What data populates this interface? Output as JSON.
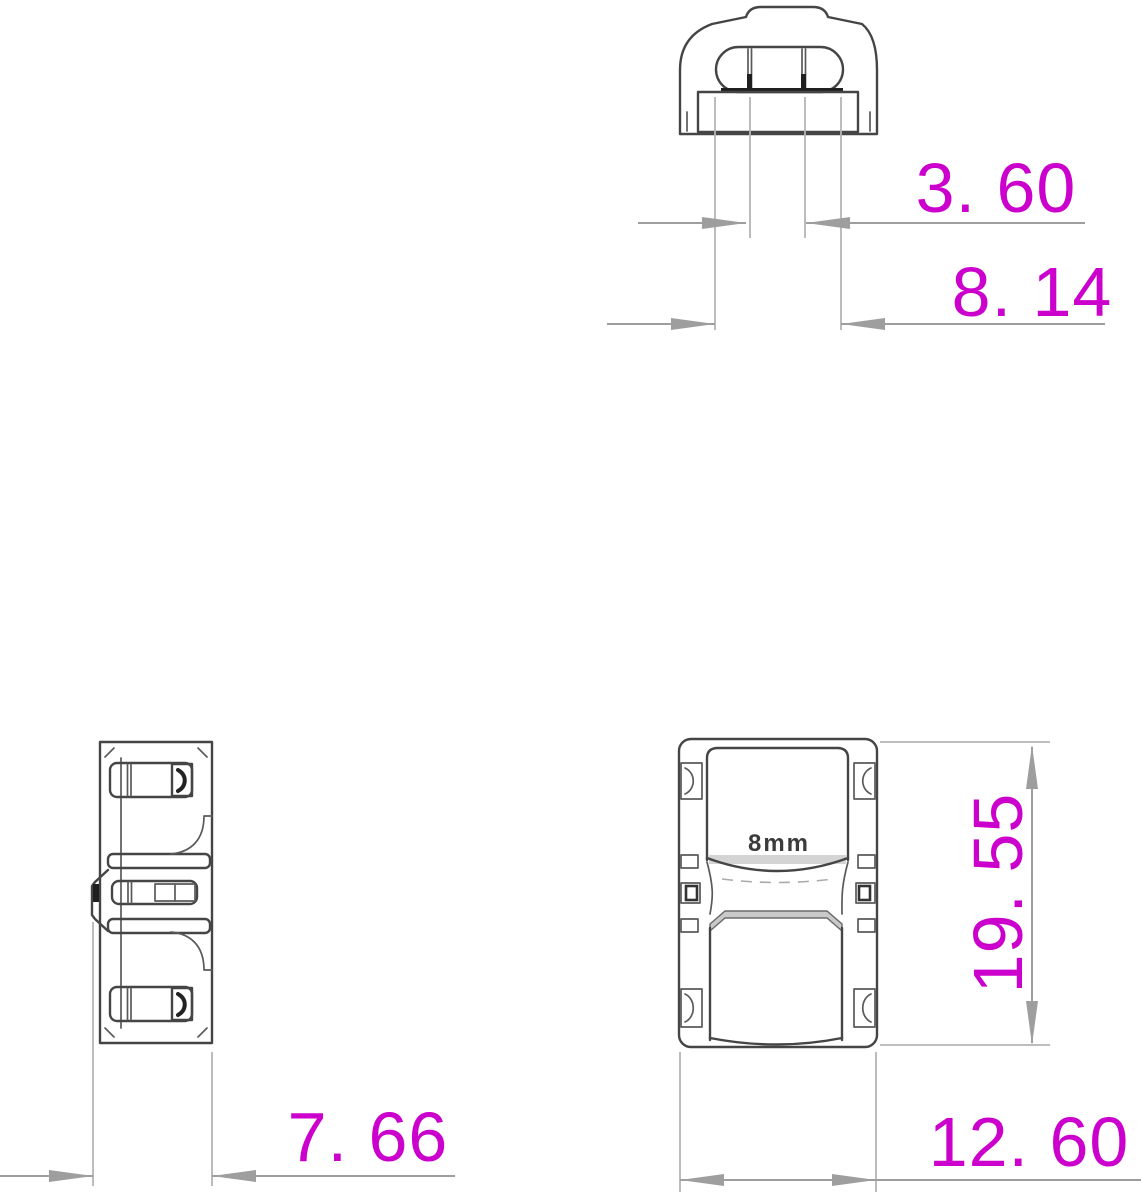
{
  "drawing": {
    "background": "#ffffff",
    "colors": {
      "dimension_text": "#cc00cc",
      "dimension_line": "#9e9e9e",
      "extension_line": "#b5b5b5",
      "part_outline": "#454545",
      "dark_detail": "#1f1f1f",
      "shading": "#c9c9c9"
    },
    "marking": {
      "front_label": "8mm"
    },
    "dimensions": {
      "slot_pitch": {
        "label": "3. 60",
        "value_mm": 3.6,
        "orientation": "horizontal",
        "view": "top"
      },
      "opening_width": {
        "label": "8. 14",
        "value_mm": 8.14,
        "orientation": "horizontal",
        "view": "top"
      },
      "body_height": {
        "label": "19. 55",
        "value_mm": 19.55,
        "orientation": "vertical",
        "view": "front"
      },
      "body_depth": {
        "label": "7. 66",
        "value_mm": 7.66,
        "orientation": "horizontal",
        "view": "side"
      },
      "body_width": {
        "label": "12. 60",
        "value_mm": 12.6,
        "orientation": "horizontal",
        "view": "front"
      }
    }
  }
}
